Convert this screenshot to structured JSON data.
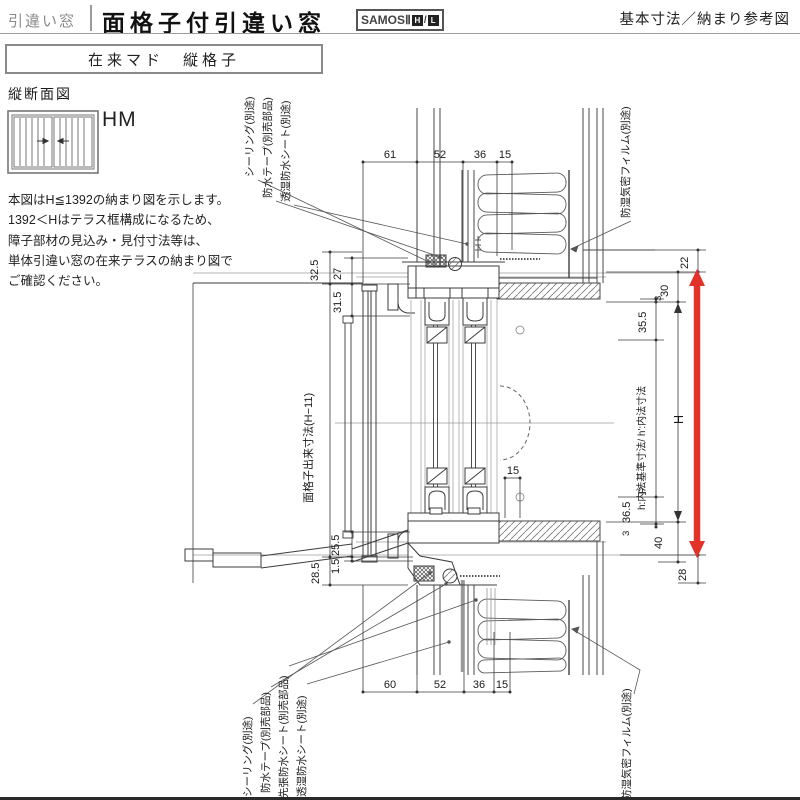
{
  "header": {
    "category": "引違い窓",
    "title": "面格子付引違い窓",
    "logo_text": "SAMOSⅡ",
    "logo_h": "H",
    "logo_l": "L",
    "right_title": "基本寸法／納まり参考図"
  },
  "subtitle": "在来マド　縦格子",
  "side": {
    "section_label": "縦断面図",
    "icon_code": "HM",
    "note_lines": [
      "本図はH≦1392の納まり図を示します。",
      "1392＜Hはテラス框構成になるため、",
      "障子部材の見込み・見付寸法等は、",
      "単体引違い窓の在来テラスの納まり図で",
      "ご確認ください。"
    ]
  },
  "drawing": {
    "callouts": {
      "top_left_1": "シーリング(別途)",
      "top_left_2": "防水テープ(別売部品)",
      "top_left_3": "透湿防水シート(別途)",
      "top_right": "防湿気密フィルム(別途)",
      "bottom_left_1": "シーリング(別途)",
      "bottom_left_2": "防水テープ(別売部品)",
      "bottom_left_3": "先張防水シート(別売部品)",
      "bottom_left_4": "透湿防水シート(別途)",
      "bottom_right": "防湿気密フィルム(別途)",
      "grille_dim": "面格子出来寸法(H−11)",
      "inner_dim": "h:内法基準寸法/ h':内法寸法"
    },
    "dims": {
      "top": [
        "61",
        "52",
        "36",
        "15"
      ],
      "bottom": [
        "60",
        "52",
        "36",
        "15"
      ],
      "left_top": [
        "32.5",
        "27",
        "31.5"
      ],
      "left_bottom": [
        "25.5",
        "1.5",
        "28.5"
      ],
      "mid15": "15",
      "right": {
        "t22": "22",
        "t30": "30",
        "t3a": "3",
        "t35_5": "35.5",
        "H": "H",
        "P": "P",
        "t36_5": "36.5",
        "t3b": "3",
        "t40": "40",
        "t28": "28"
      }
    }
  },
  "colors": {
    "accent_red": "#e2322a",
    "line": "#3c3c3c",
    "line_light": "#b5b5b5"
  }
}
